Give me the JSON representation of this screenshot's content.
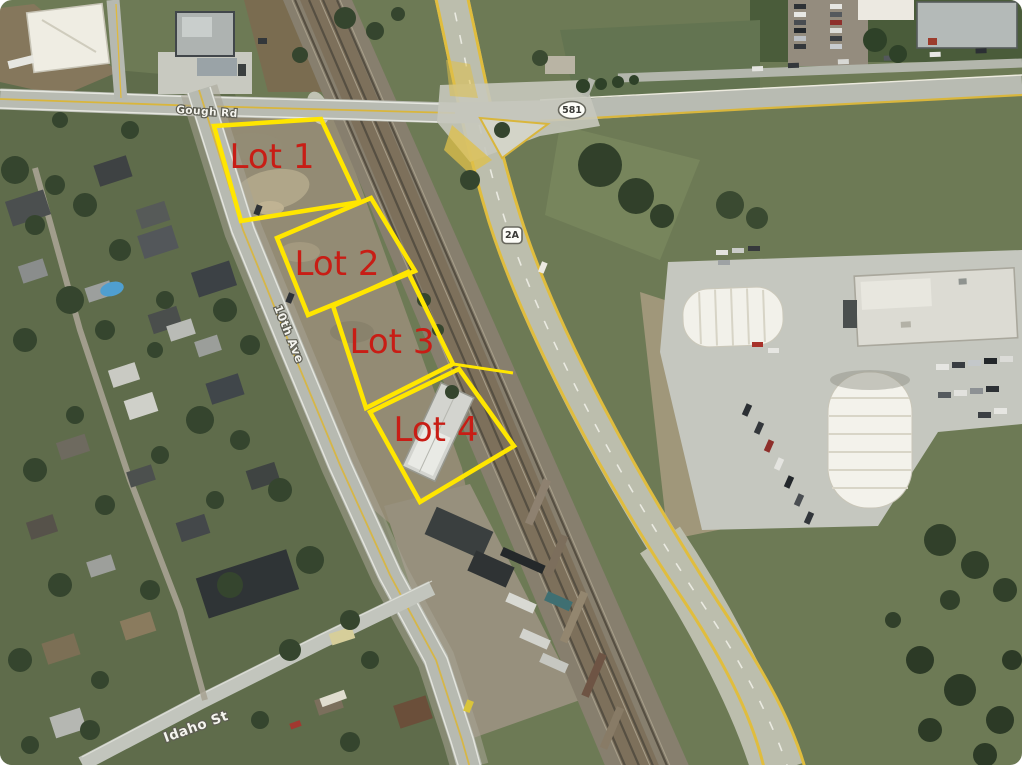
{
  "map": {
    "kind": "satellite-aerial-photo",
    "width": 1022,
    "height": 768
  },
  "annotations": {
    "lot_outline_color": "#ffe600",
    "lot_label_color": "#c81d15",
    "lots": [
      {
        "label": "Lot 1",
        "polygon": [
          [
            214,
            126
          ],
          [
            321,
            119
          ],
          [
            360,
            202
          ],
          [
            241,
            221
          ]
        ],
        "label_pos": [
          272,
          157
        ]
      },
      {
        "label": "Lot 2",
        "polygon": [
          [
            277,
            238
          ],
          [
            371,
            198
          ],
          [
            415,
            271
          ],
          [
            308,
            315
          ]
        ],
        "label_pos": [
          337,
          264
        ]
      },
      {
        "label": "Lot 3",
        "polygon": [
          [
            333,
            306
          ],
          [
            408,
            272
          ],
          [
            453,
            364
          ],
          [
            366,
            408
          ]
        ],
        "label_pos": [
          392,
          342
        ]
      },
      {
        "label": "Lot 4",
        "polygon": [
          [
            370,
            412
          ],
          [
            459,
            369
          ],
          [
            514,
            446
          ],
          [
            420,
            502
          ]
        ],
        "label_pos": [
          436,
          430
        ]
      }
    ],
    "boundary_extension": [
      [
        453,
        364
      ],
      [
        513,
        373
      ]
    ]
  },
  "road_labels": [
    {
      "name": "gough-rd",
      "text": "Gough Rd",
      "pos": [
        207,
        112
      ],
      "rotate": 4
    },
    {
      "name": "10th-ave",
      "text": "10th Ave",
      "pos": [
        289,
        334
      ],
      "rotate": 68
    },
    {
      "name": "idaho-st",
      "text": "Idaho St",
      "pos": [
        196,
        727
      ],
      "rotate": -20
    }
  ],
  "highway_shields": [
    {
      "name": "hwy-581",
      "text": "581",
      "shape": "oval",
      "pos": [
        572,
        110
      ]
    },
    {
      "name": "hwy-2a",
      "text": "2A",
      "shape": "shield",
      "pos": [
        512,
        235
      ]
    }
  ]
}
